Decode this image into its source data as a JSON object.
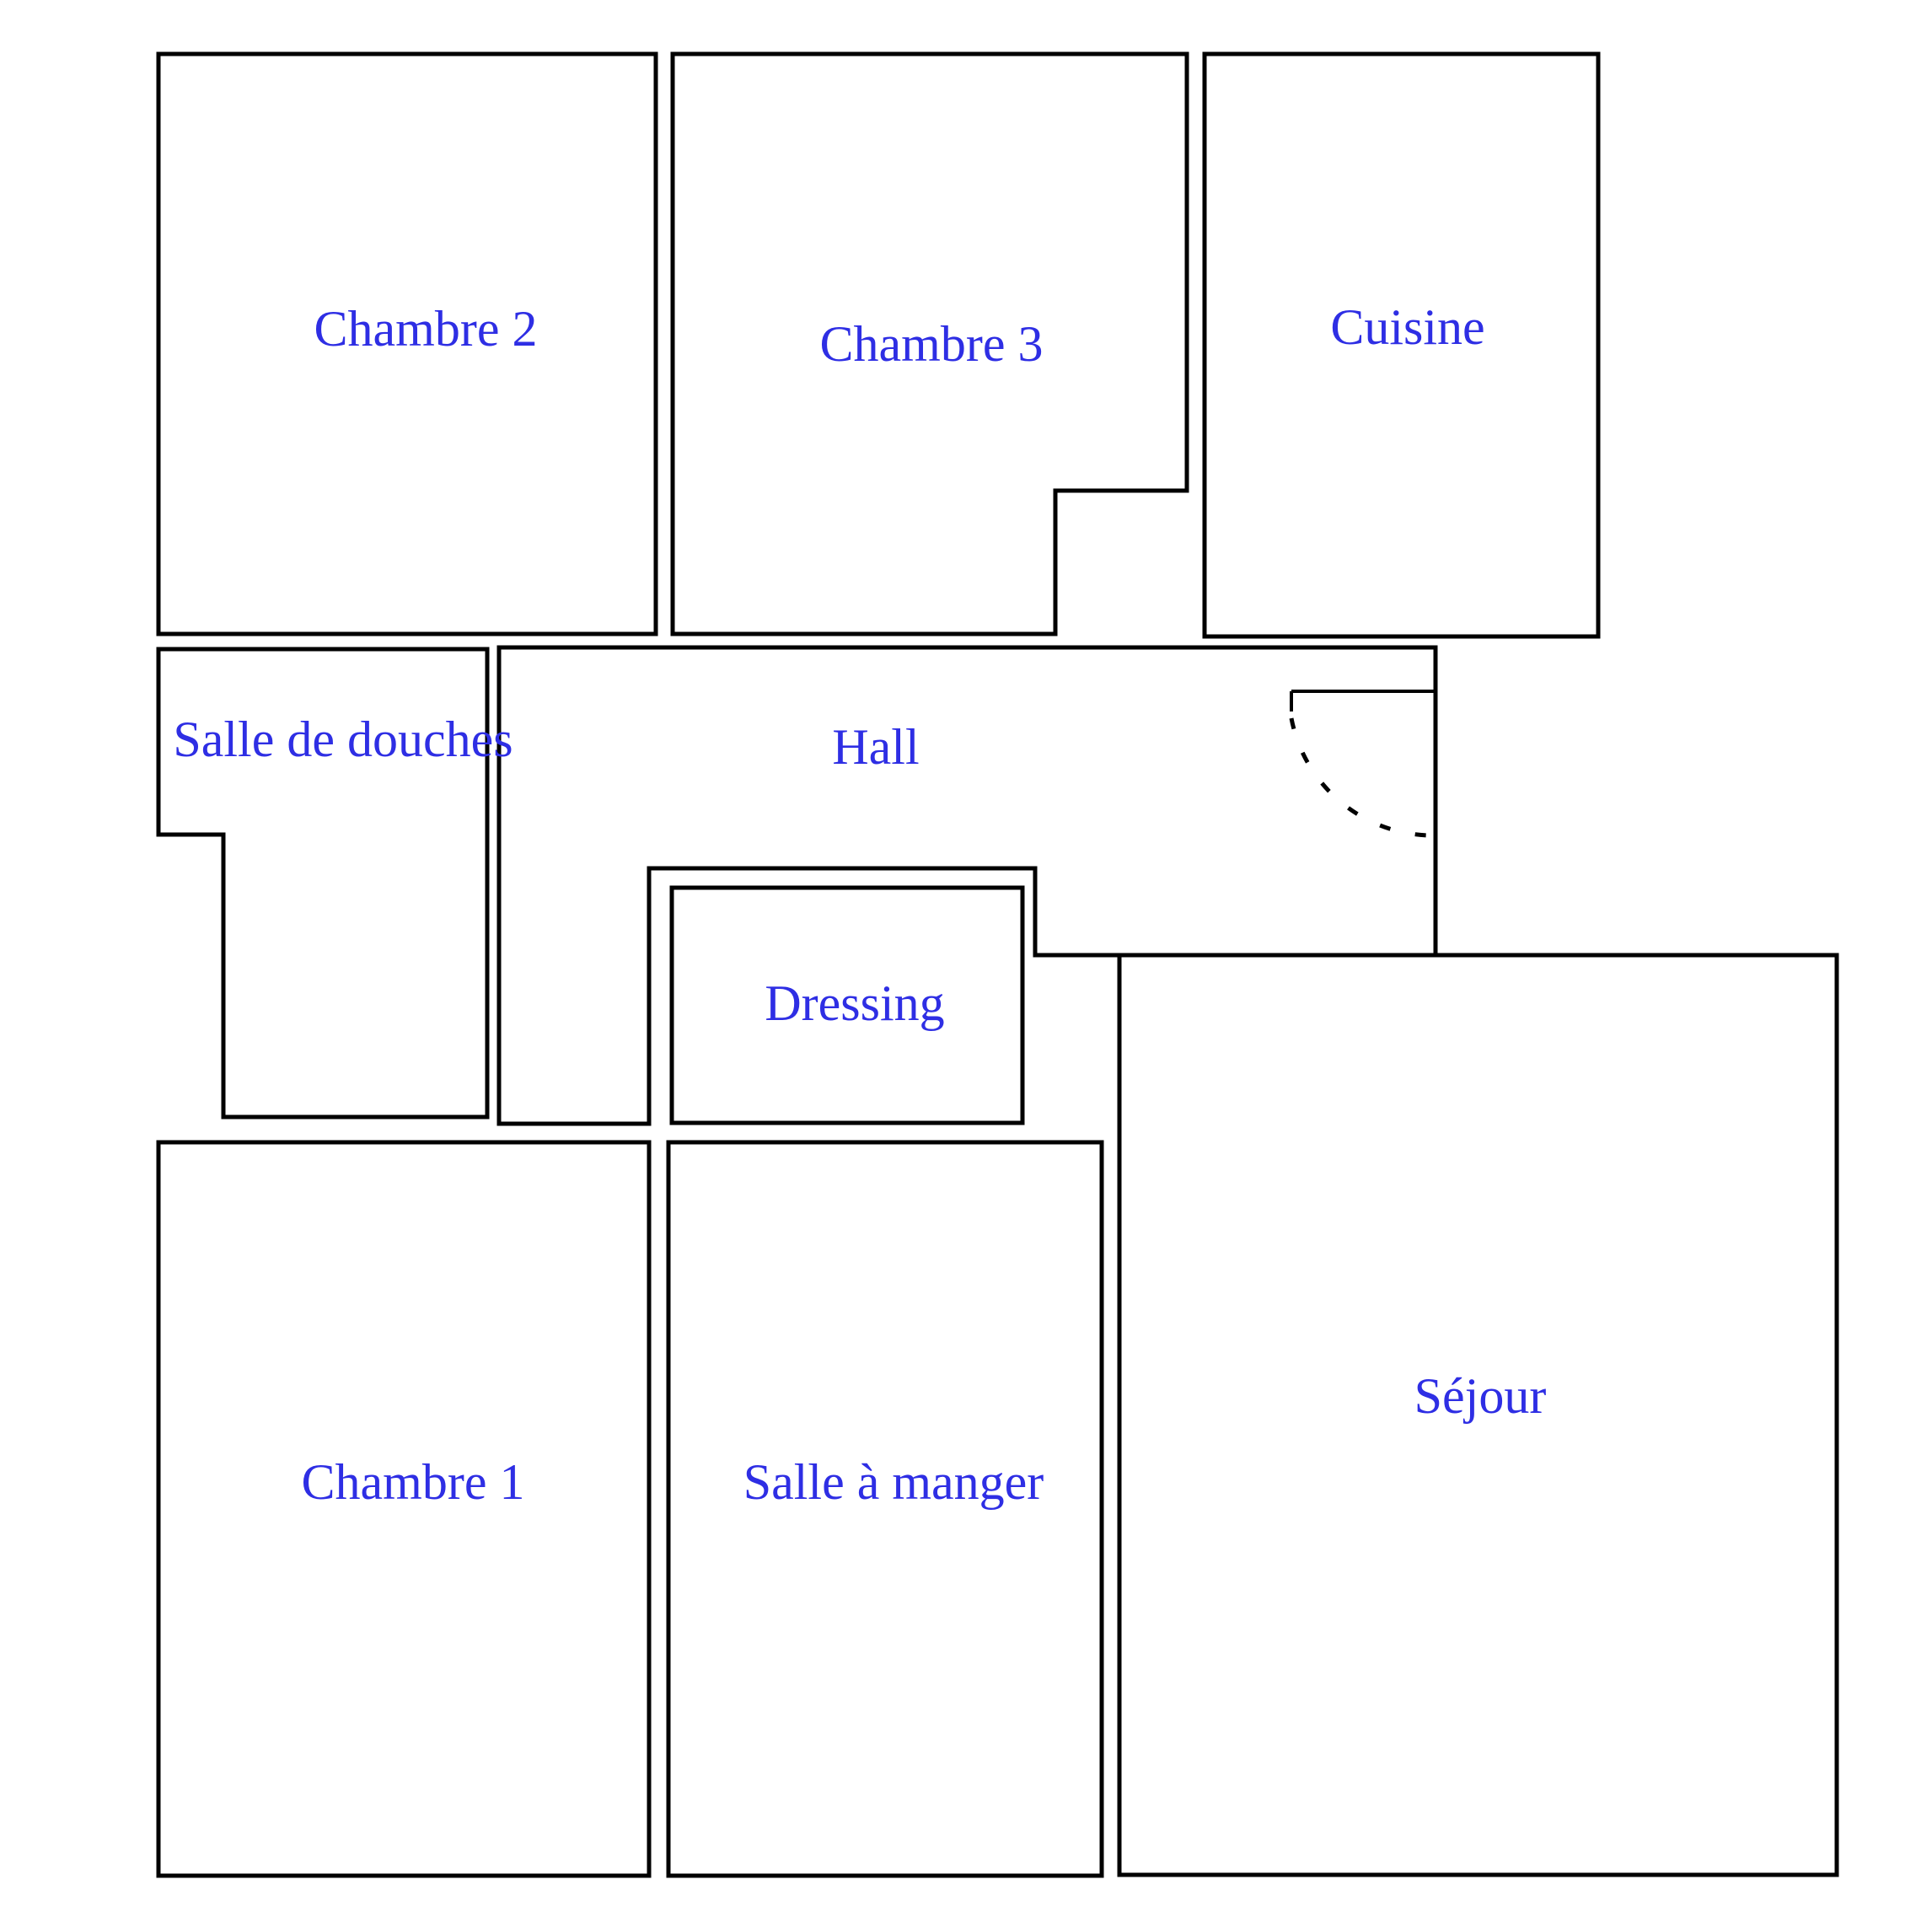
{
  "colors": {
    "background": "#ffffff",
    "walls": "#000000",
    "room_labels": "#2e2ee4"
  },
  "rooms": {
    "chambre2": {
      "label": "Chambre 2"
    },
    "chambre3": {
      "label": "Chambre 3"
    },
    "cuisine": {
      "label": "Cuisine"
    },
    "salle_de_douches": {
      "label": "Salle de douches"
    },
    "hall": {
      "label": "Hall"
    },
    "dressing": {
      "label": "Dressing"
    },
    "chambre1": {
      "label": "Chambre 1"
    },
    "salle_a_manger": {
      "label": "Salle à manger"
    },
    "sejour": {
      "label": "Séjour"
    }
  }
}
